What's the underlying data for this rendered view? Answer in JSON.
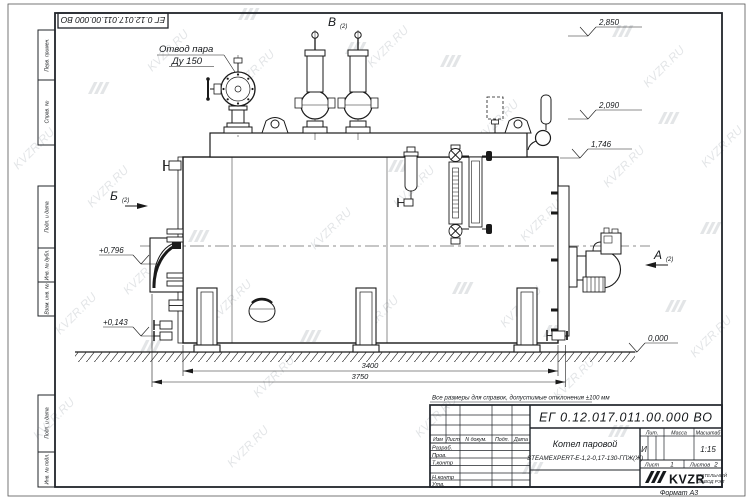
{
  "watermark": {
    "text": "KVZR.RU"
  },
  "frame": {
    "doc_number_top": "ЕГ 0.12.017.011.00.000  ВО",
    "format_label": "Формат А3",
    "margin_labels": [
      "Перв. примен.",
      "Справ. №",
      "Подп. и дата",
      "Инв. № дубл.",
      "Взам. инв. №",
      "Подп. и дата",
      "Инв. № подл."
    ]
  },
  "title_block": {
    "doc_number": "ЕГ 0.12.017.011.00.000  ВО",
    "note": "Все размеры для справок, допустимые отклонения ±100 мм",
    "product_name": "Котел паровой",
    "product_model": "STEAMEXPERT-Е-1,2-0,17-130-ГПЖ(Ж)",
    "header": {
      "izm": "Изм",
      "list": "Лист",
      "doc": "N докум.",
      "podp": "Подп.",
      "data": "Дата"
    },
    "rows": [
      "Разраб.",
      "Пров.",
      "Т.контр",
      "Н.контр",
      "Утв."
    ],
    "lit_label": "Лит.",
    "lit_value": "И",
    "mass_label": "Масса",
    "scale_label": "Масштаб",
    "scale_value": "1:15",
    "sheet_label": "Лист",
    "sheet_value": "1",
    "sheets_label": "Листов",
    "sheets_value": "2",
    "company": {
      "logo": "KVZR",
      "line1": "КОТЕЛЬНЫЙ",
      "line2": "ЗАВОД РЭП"
    }
  },
  "drawing": {
    "callout_line1": "Отвод пара",
    "callout_line2": "Ду 150",
    "views": {
      "b": "Б",
      "v": "В",
      "a": "А",
      "sheet_ref": "(2)"
    },
    "elevations": {
      "top": "2,850",
      "deck": "2,090",
      "shell": "1,746",
      "burner": "+0,796",
      "low": "+0,143",
      "ground": "0,000"
    },
    "dims": {
      "shell_length": "3400",
      "overall_length": "3750"
    }
  }
}
